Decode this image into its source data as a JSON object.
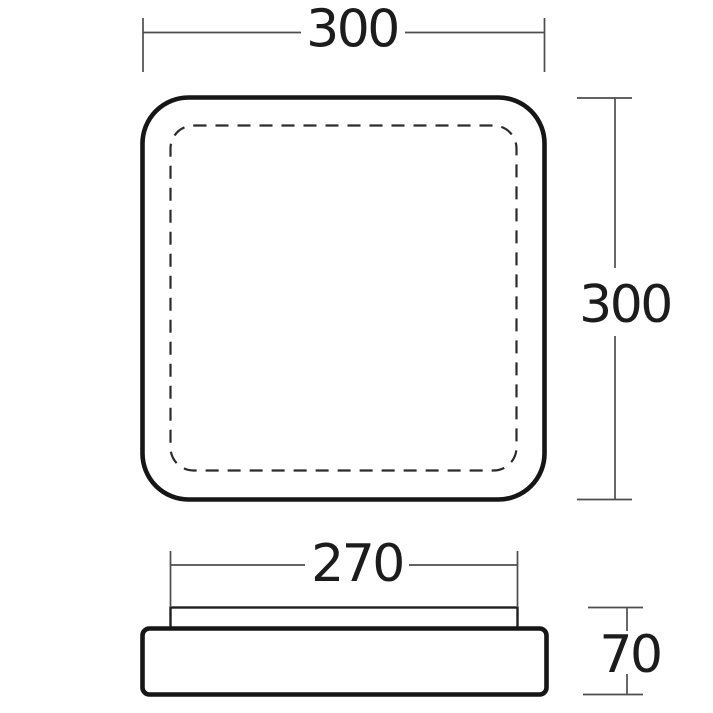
{
  "colors": {
    "background": "#ffffff",
    "outline": "#161616",
    "dimension_lines": "#4d4d4d",
    "label_text": "#1c1c1c"
  },
  "top_view": {
    "width_dimension": "300",
    "height_dimension": "300"
  },
  "side_view": {
    "diffuser_width_dimension": "270",
    "height_dimension": "70"
  }
}
